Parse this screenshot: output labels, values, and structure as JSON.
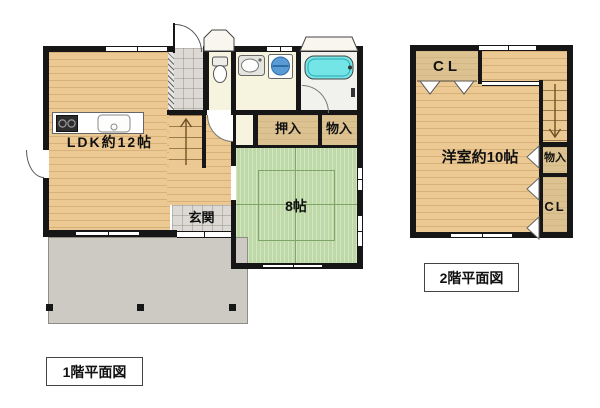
{
  "floor1": {
    "caption": "1階平面図",
    "rooms": {
      "ldk": "LDK約12帖",
      "genkan": "玄関",
      "oshiire": "押入",
      "monoire": "物入",
      "washitsu": "8帖"
    }
  },
  "floor2": {
    "caption": "2階平面図",
    "rooms": {
      "yoshitsu": "洋室約10帖",
      "closet_top": "CL",
      "monoire": "物入",
      "closet_bottom": "CL"
    }
  },
  "icons": {
    "kitchen": [
      "stove-icon",
      "sink-icon"
    ],
    "sanitary": [
      "toilet-icon",
      "washbasin-icon",
      "washing-machine-icon",
      "bathtub-icon"
    ],
    "circulation": [
      "stairs-up-arrow-icon",
      "stairs-down-arrow-icon",
      "door-swing-arc"
    ]
  },
  "colors": {
    "wall": "#161616",
    "wood_floor": "#ecc892",
    "tatami": "#bed9a7",
    "closet": "#dcc290",
    "sanitary_floor": "#f6f3df",
    "bath_floor": "#f1f1ed",
    "entry_tile": "#dcd9d4",
    "porch": "#cdcac4",
    "bathtub": "#74e5e6",
    "washer": "#5b9bd5"
  }
}
